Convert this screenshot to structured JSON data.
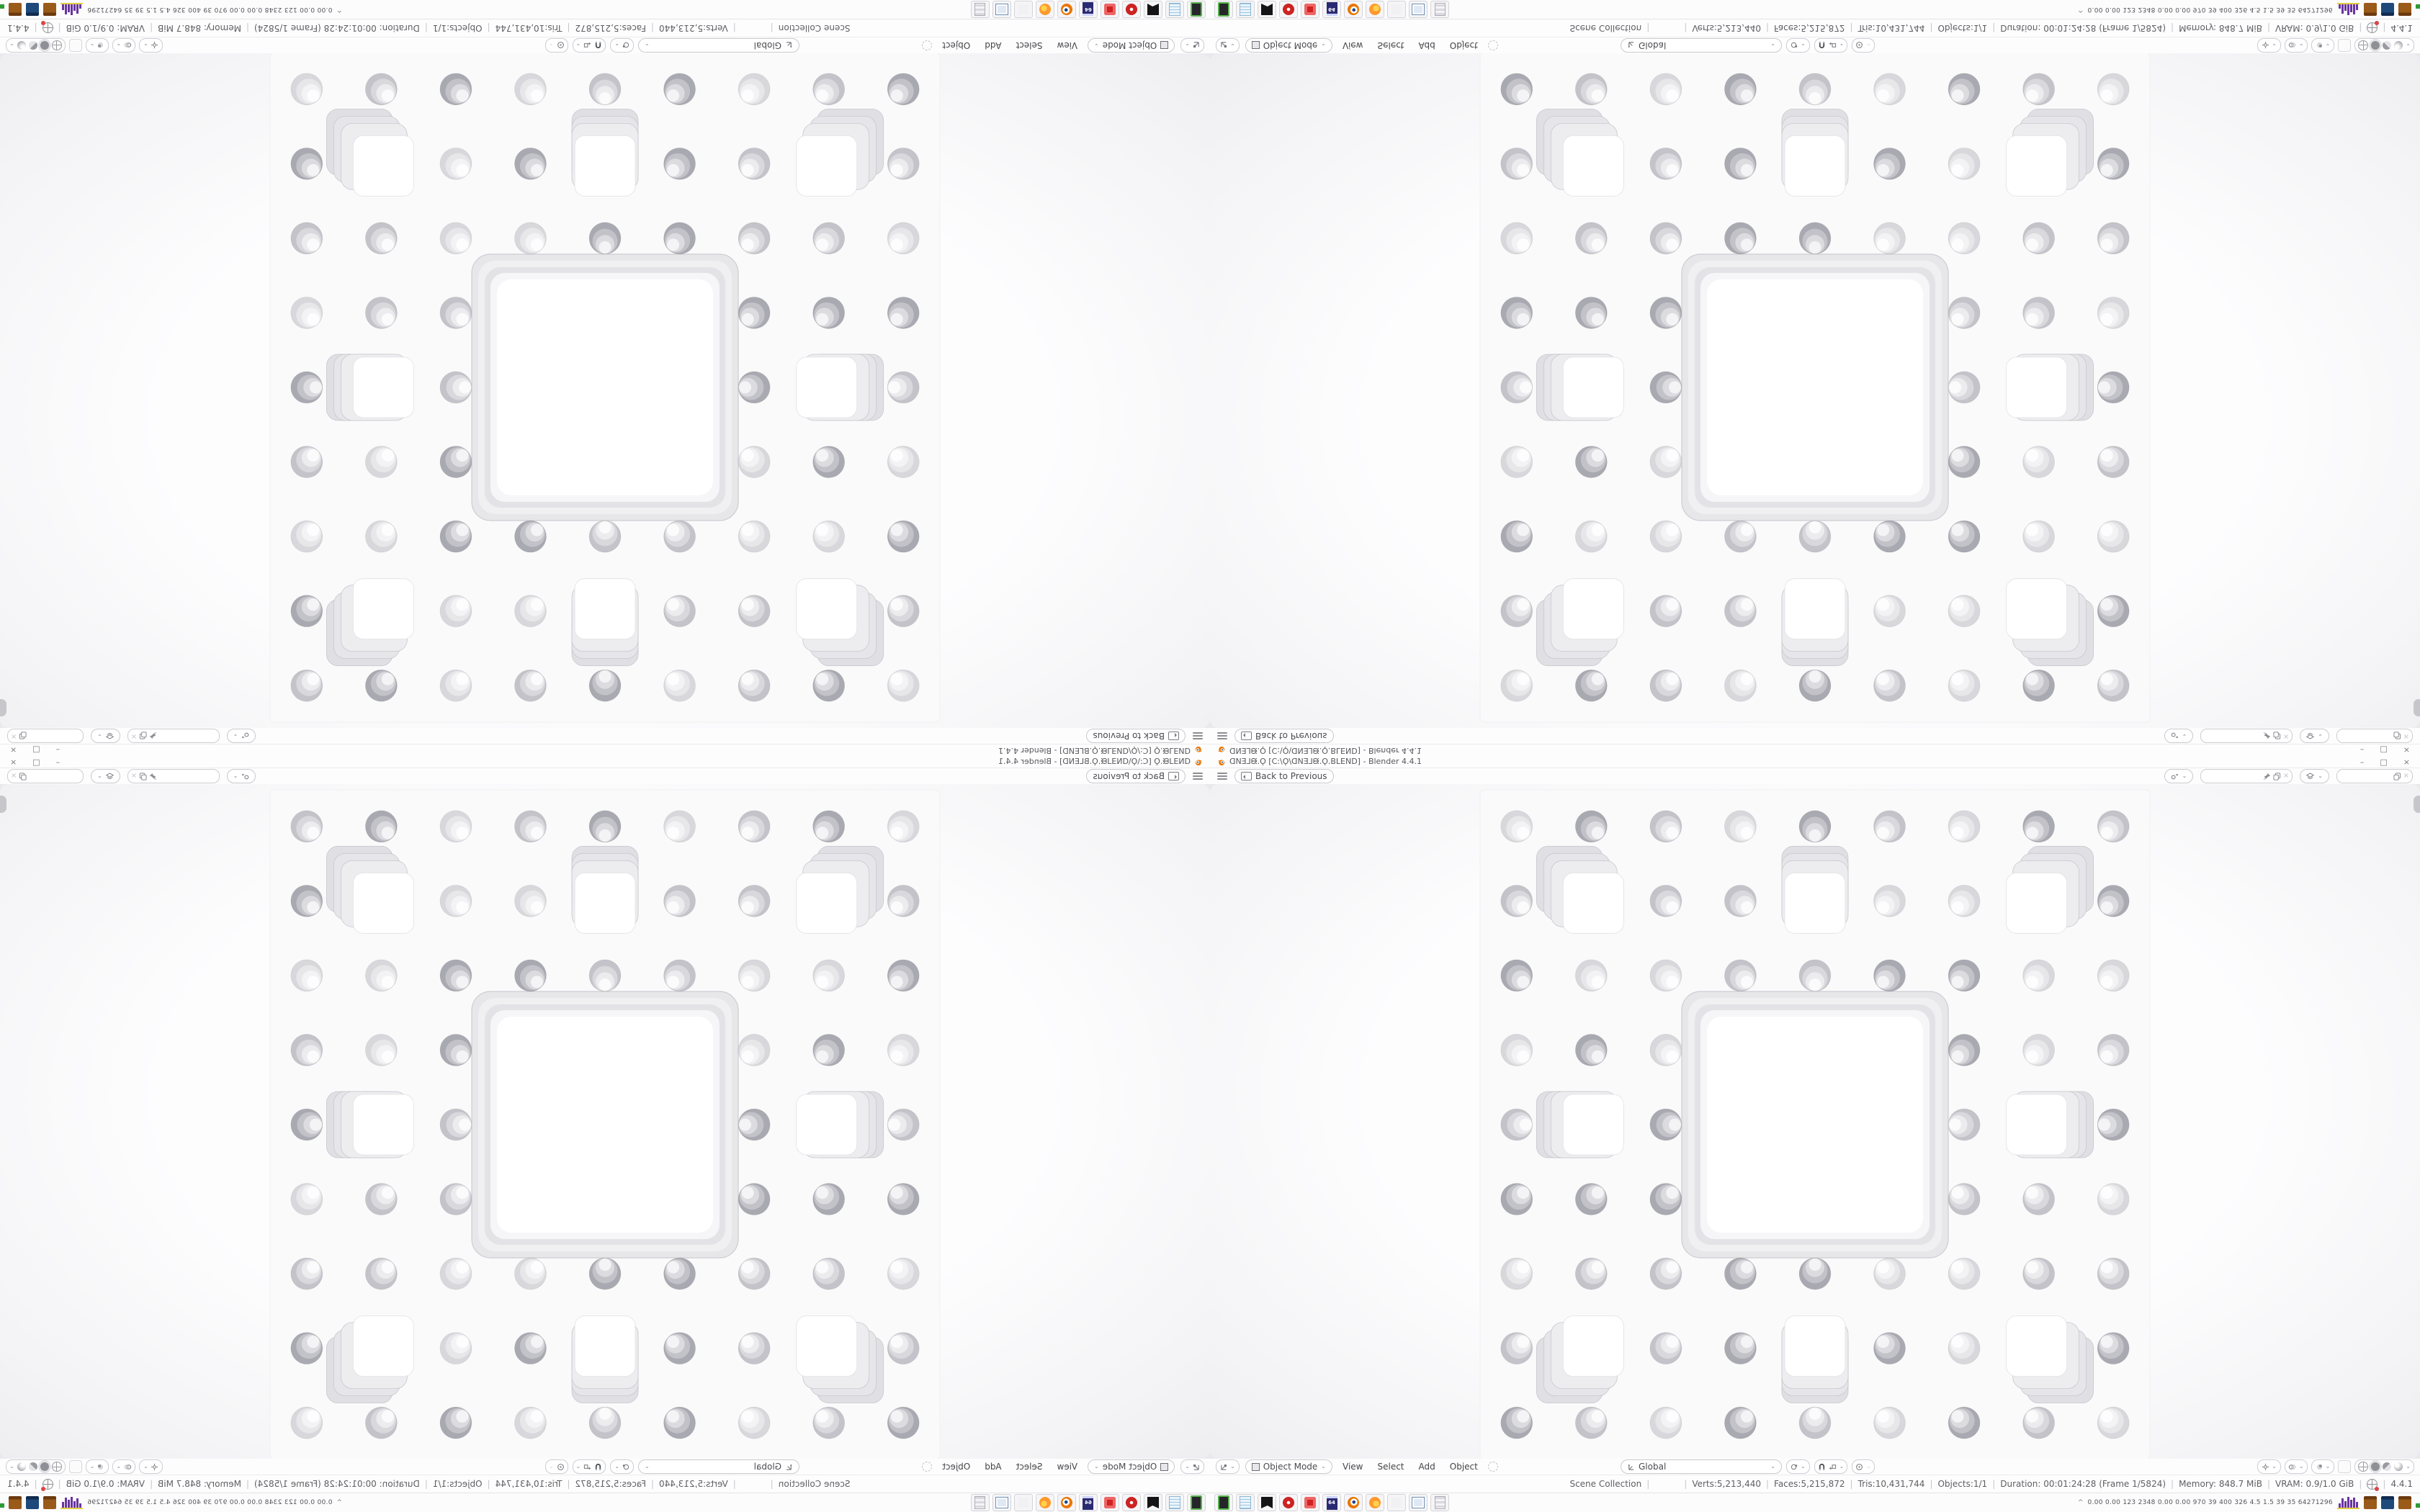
{
  "app": {
    "name": "Blender"
  },
  "glyphs": {
    "chevron": "⌄",
    "separator": "|",
    "minimize": "–",
    "maximize": "□",
    "close": "×",
    "unlink": "×",
    "tray_expander": "^"
  },
  "window": {
    "title": "ᗡNƎ⅃ᙠ.Ǫ [C:\\Ǫ\\ᗡNƎ⅃ᙠ.Ǫ.BLEND] - Blender 4.4.1",
    "topbar": {
      "back_label": "Back to Previous"
    },
    "viewport_header": {
      "mode_label": "Object Mode",
      "menu_view": "View",
      "menu_select": "Select",
      "menu_add": "Add",
      "menu_object": "Object",
      "orientation_label": "Global"
    },
    "status": {
      "scene": "Scene Collection",
      "object": "",
      "verts": "Verts:5,213,440",
      "faces": "Faces:5,215,872",
      "tris": "Tris:10,431,744",
      "objects": "Objects:1/1",
      "duration": "Duration: 00:01:24:28 (Frame 1/5824)",
      "memory": "Memory: 848.7 MiB",
      "vram": "VRAM: 0.9/1.0 GiB",
      "version": "4.4.1"
    },
    "taskbar": {
      "apps": [
        "audio-device",
        "notepad",
        "inkscape",
        "red-media",
        "red-gear",
        "floppy-64",
        "blender",
        "firefox",
        "blank",
        "system-monitor",
        "calculator"
      ],
      "floppy_label": "64",
      "tray_text": "0.00 0.00 123 2348 0.00 0.00 970 39 400 326 4.5 1.5 39 35 64271296"
    }
  },
  "scene": {
    "type": "menger-sponge-render",
    "grid": 9,
    "cell_size": 103.55,
    "sub_centers": [
      [
        1,
        1
      ],
      [
        4,
        1
      ],
      [
        7,
        1
      ],
      [
        1,
        4
      ],
      [
        7,
        4
      ],
      [
        1,
        7
      ],
      [
        4,
        7
      ],
      [
        7,
        7
      ]
    ],
    "colors": {
      "slab": "#fafafb",
      "hole_white": "#ffffff",
      "square_layers": [
        "#ededf0",
        "#e6e6ea",
        "#dfdfe4"
      ],
      "square_edge": "#c8c8cd",
      "big_layers": [
        "#e7e7ea",
        "#f0f0f2",
        "#e3e3e7",
        "#f6f6f8"
      ],
      "circle_tiers": [
        [
          "#d8d8dc",
          "#e7e7ea",
          "#f3f3f5",
          "#fdfdfe"
        ],
        [
          "#c3c3c9",
          "#d8d8dd",
          "#ececef",
          "#fbfbfc"
        ],
        [
          "#a9a9b1",
          "#c2c2c8",
          "#dcdce0",
          "#f4f4f6"
        ]
      ]
    },
    "hist_bars": [
      6,
      13,
      9,
      15,
      11,
      14,
      8
    ]
  }
}
